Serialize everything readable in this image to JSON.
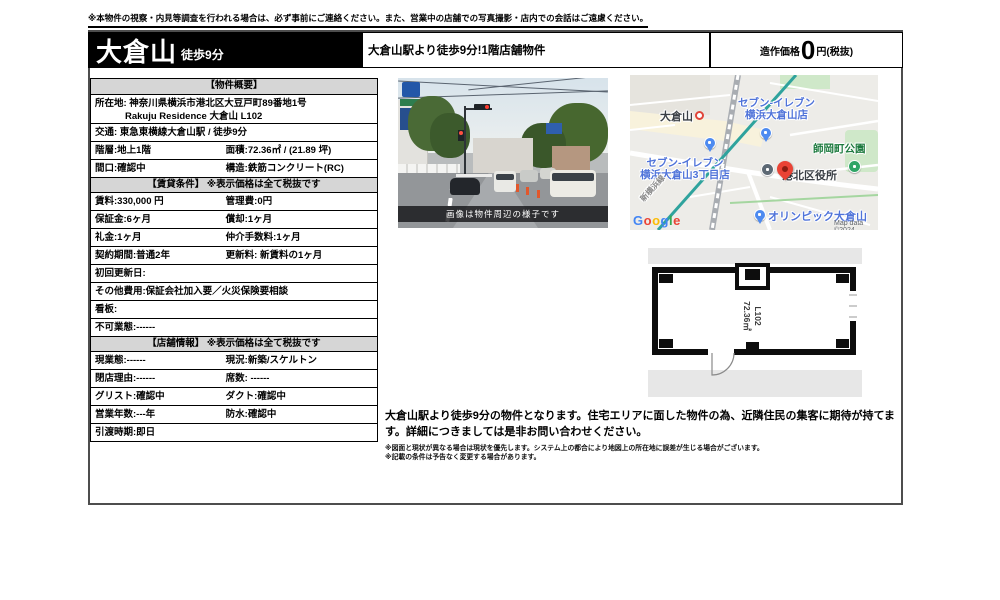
{
  "page": {
    "disclaimer": "※本物件の視察・内見等調査を行われる場合は、必ず事前にご連絡ください。また、営業中の店舗での写真撮影・店内での会話はご遠慮ください。"
  },
  "header": {
    "title": "大倉山",
    "title_suffix": "徒歩9分",
    "subtitle": "大倉山駅より徒歩9分!1階店舗物件",
    "price_label": "造作価格",
    "price_value": "0",
    "price_unit": "円(税抜)"
  },
  "table": {
    "rows": [
      {
        "type": "head",
        "text": "【物件概要】"
      },
      {
        "type": "addr",
        "line1": "所在地: 神奈川県横浜市港北区大豆戸町89番地1号",
        "line2": "Rakuju Residence 大倉山 L102"
      },
      {
        "type": "full",
        "text": "交通: 東急東横線大倉山駅 / 徒歩9分"
      },
      {
        "type": "two",
        "a": "階層:地上1階",
        "b": "面積:72.36㎡ / (21.89 坪)"
      },
      {
        "type": "two",
        "a": "間口:確認中",
        "b": "構造:鉄筋コンクリート(RC)"
      },
      {
        "type": "head",
        "text": "【賃貸条件】 ※表示価格は全て税抜です"
      },
      {
        "type": "two",
        "a": "賃料:330,000 円",
        "b": "管理費:0円"
      },
      {
        "type": "two",
        "a": "保証金:6ヶ月",
        "b": "償却:1ヶ月"
      },
      {
        "type": "two",
        "a": "礼金:1ヶ月",
        "b": "仲介手数料:1ヶ月"
      },
      {
        "type": "two",
        "a": "契約期間:普通2年",
        "b": "更新料: 新賃料の1ヶ月"
      },
      {
        "type": "full",
        "text": "初回更新日:"
      },
      {
        "type": "full",
        "text": "その他費用:保証会社加入要／火災保険要相談"
      },
      {
        "type": "full",
        "text": "看板:"
      },
      {
        "type": "full",
        "text": "不可業態:------"
      },
      {
        "type": "head",
        "text": "【店舗情報】 ※表示価格は全て税抜です"
      },
      {
        "type": "two",
        "a": "現業態:------",
        "b": "現況:新築/スケルトン"
      },
      {
        "type": "two",
        "a": "閉店理由:------",
        "b": "席数: ------"
      },
      {
        "type": "two",
        "a": "グリスト:確認中",
        "b": "ダクト:確認中"
      },
      {
        "type": "two",
        "a": "営業年数:---年",
        "b": "防水:確認中"
      },
      {
        "type": "full",
        "text": "引渡時期:即日"
      }
    ]
  },
  "photo": {
    "caption": "画像は物件周辺の様子です"
  },
  "map": {
    "station": "大倉山",
    "seven1_line1": "セブン-イレブン",
    "seven1_line2": "横浜大倉山店",
    "seven2_line1": "セブン-イレブン",
    "seven2_line2": "横浜大倉山3丁目店",
    "park": "師岡町公園",
    "ward_office": "港北区役所",
    "olympic": "オリンピック大倉山",
    "rail_line": "新横浜線",
    "logo": [
      "G",
      "o",
      "o",
      "g",
      "l",
      "e"
    ],
    "copyright": "Map data ©2024"
  },
  "plan": {
    "unit": "L102",
    "area": "72.36㎡"
  },
  "description": {
    "main": "大倉山駅より徒歩9分の物件となります。住宅エリアに面した物件の為、近隣住民の集客に期待が持てます。詳細につきましては是非お問い合わせください。",
    "note1": "※図面と現状が異なる場合は現状を優先します。システム上の都合により地図上の所在地に誤差が生じる場合がございます。",
    "note2": "※記載の条件は予告なく変更する場合があります。"
  },
  "colors": {
    "header_bg": "#000000",
    "section_header_bg": "#d6d6d6",
    "map_poi_blue": "#4f73d9",
    "map_park_green": "#2fa566",
    "map_pin_red": "#ea4335",
    "map_rail_teal": "#2fa39d",
    "caption_bar": "rgba(15,15,18,0.78)"
  }
}
